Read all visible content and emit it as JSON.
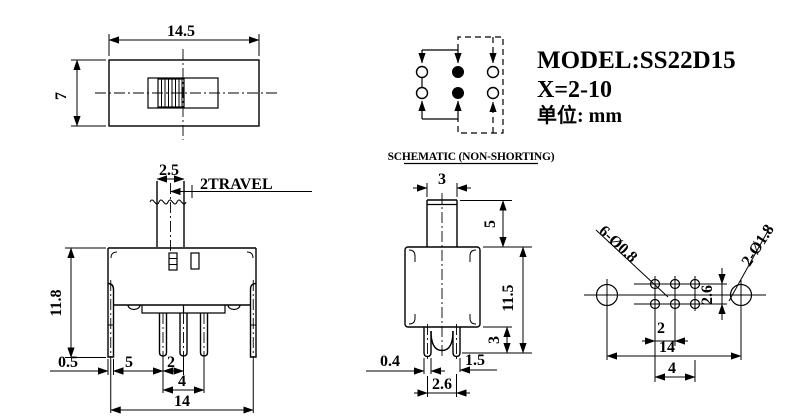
{
  "title_block": {
    "model": "MODEL:SS22D15",
    "travel_range": "X=2-10",
    "units": "单位: mm"
  },
  "schematic": {
    "caption": "SCHEMATIC (NON-SHORTING)"
  },
  "top_view": {
    "width": "14.5",
    "height": "7"
  },
  "front_view": {
    "knob_width": "2.5",
    "travel_label": "2TRAVEL",
    "body_height": "11.8",
    "lug_thickness": "0.5",
    "lug_to_pin": "5",
    "pin_pitch": "2",
    "pin_span": "4",
    "lug_span": "14"
  },
  "side_view": {
    "knob_width": "3",
    "knob_height": "5",
    "body_height": "11.5",
    "leg_length": "3",
    "leg_thickness": "0.4",
    "leg_offset": "1.5",
    "leg_span": "2.6"
  },
  "footprint": {
    "small_holes": "6-Ø0.8",
    "large_holes": "2-Ø1.8",
    "row_pitch": "2.6",
    "hole_pitch": "2",
    "mount_span": "14",
    "hole_span": "4"
  },
  "colors": {
    "line": "#000000",
    "background": "#ffffff"
  }
}
